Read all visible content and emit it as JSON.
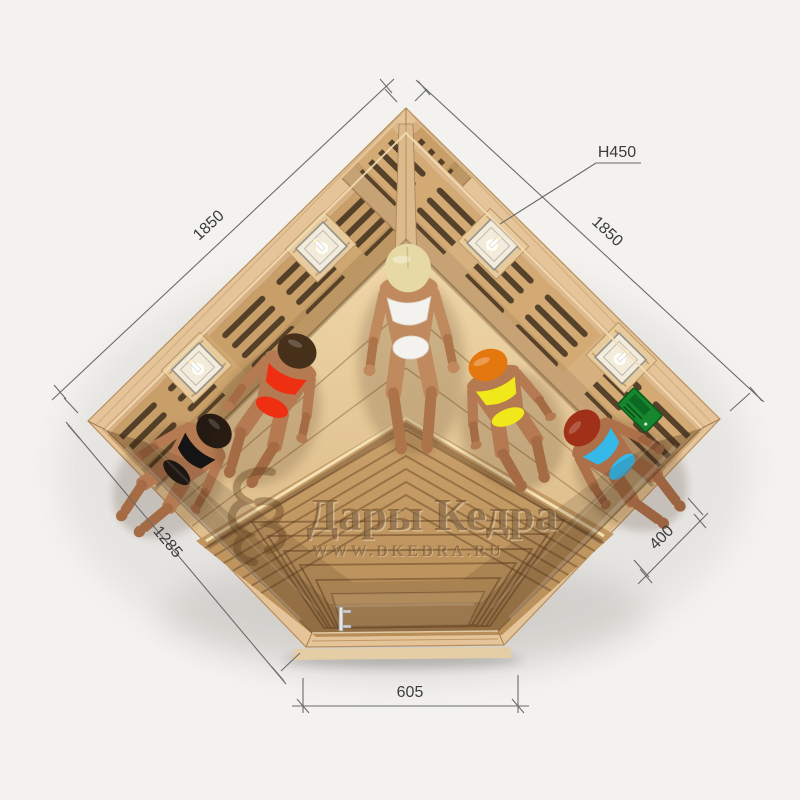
{
  "watermark": {
    "brand": "Дары Кедра",
    "website": "WWW.DKEDRA.RU",
    "color": "#5f3f1d"
  },
  "dimensions": {
    "wall_left": "1850",
    "wall_right": "1850",
    "height": "H450",
    "glass_left": "1285",
    "glass_right": "400",
    "door_front": "605"
  },
  "annotation": {
    "line_color": "#6b6b6b",
    "text_color": "#3c3c3c"
  },
  "sauna": {
    "type": "corner infrared sauna, top view",
    "lamps_count": 4,
    "control_panel_color": "#17862f",
    "wood_light": "#e4c498",
    "wood_mid": "#cfa771",
    "heater_slot_dark": "#3a2b1a",
    "bench_color": "#eed5a6",
    "floor_top": "#d6b384",
    "floor_bottom": "#b98f5a",
    "glass_tint": "#3a2412",
    "people": [
      {
        "id": "person-1",
        "position": "left bench",
        "hair_color": "#241a12",
        "swimsuit_color": "#141414",
        "skin_color": "#b57a52"
      },
      {
        "id": "person-2",
        "position": "left-center bench",
        "hair_color": "#47301a",
        "swimsuit_color": "#ee2f12",
        "skin_color": "#b57a52"
      },
      {
        "id": "person-3",
        "position": "corner bench",
        "hair_color": "#e7d9a5",
        "swimsuit_color": "#f4f2ee",
        "skin_color": "#c08a5e"
      },
      {
        "id": "person-4",
        "position": "right-center bench",
        "hair_color": "#e5770f",
        "swimsuit_color": "#f0e81a",
        "skin_color": "#b57a52"
      },
      {
        "id": "person-5",
        "position": "right bench",
        "hair_color": "#a03018",
        "swimsuit_color": "#34b9e9",
        "skin_color": "#ad7049"
      }
    ]
  }
}
